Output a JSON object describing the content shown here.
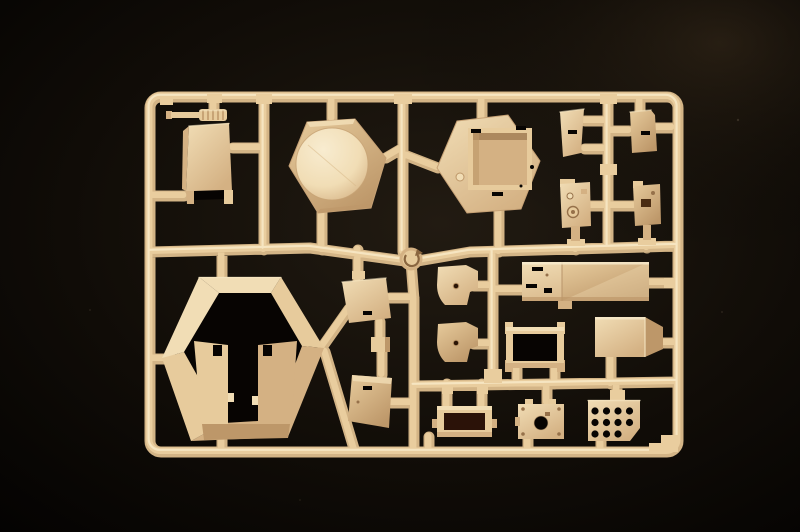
{
  "scene": {
    "type": "photograph",
    "subject": "injection-molded plastic model kit sprue (parts runner) for an armored-vehicle kit",
    "background": "black surface, soft vignette lighting",
    "material": "matte tan styrene plastic"
  },
  "colors": {
    "background": "#070503",
    "vignette_inner": "#221b12",
    "vignette_outer": "#020101",
    "vignette_glow": "#4e3c26",
    "runner_base": "#d3b486",
    "runner_mid": "#e9cd9e",
    "runner_highlight": "#f8e9c7",
    "plastic_highlight": "#f8ecd0",
    "plastic_light": "#f1ddb5",
    "plastic_mid": "#e7cb9c",
    "plastic_shade": "#d4b183",
    "plastic_shadow": "#bd9769",
    "plastic_dark": "#96714a",
    "hole": "#070402",
    "hole_warm": "#2b1208"
  },
  "sprue": {
    "frame": "rounded-rectangle outer runner frame with internal runner lattice",
    "gate_medallion": "circular injection-gate medallion with curved arrow mark at the central runner junction",
    "corner_tab": "L-shaped reinforcement tab inside the bottom-right frame corner",
    "part_count": 20,
    "grille": {
      "hole_count": 11,
      "hole_rows": [
        4,
        4,
        3
      ]
    },
    "parts": [
      {
        "name": "ribbed-cylinder",
        "description": "small ribbed cylindrical part with thin rod",
        "area": "top-left, above stowage box"
      },
      {
        "name": "stowage-box",
        "description": "rectangular box with chamfered edge and open underside",
        "area": "top-left"
      },
      {
        "name": "turret-roof",
        "description": "hexagonal panel with large raised circular disc",
        "area": "top-center"
      },
      {
        "name": "turret-base",
        "description": "hexagonal panel with recessed rectangular bay, corner slots and locating knob",
        "area": "top-center-right"
      },
      {
        "name": "wedge-panel-a",
        "description": "angled trapezoid panel with slot",
        "area": "top-right"
      },
      {
        "name": "wedge-panel-b",
        "description": "angled trapezoid panel with slot",
        "area": "top-right"
      },
      {
        "name": "sight-housing-a",
        "description": "small housing with round sight ring and mounting peg",
        "area": "upper-right"
      },
      {
        "name": "sight-housing-b",
        "description": "small housing with rectangular port and mounting peg",
        "area": "upper-right"
      },
      {
        "name": "turret-shell",
        "description": "large open hexagonal turret ring with notched inner front walls",
        "area": "bottom-left"
      },
      {
        "name": "skirt-wedge-a",
        "description": "trapezoid skirt panel with slot",
        "area": "center"
      },
      {
        "name": "spacer-block",
        "description": "small rectangular block",
        "area": "center"
      },
      {
        "name": "skirt-wedge-b",
        "description": "trapezoid skirt panel with slot",
        "area": "center"
      },
      {
        "name": "bracket-a",
        "description": "curved mounting bracket with small hole",
        "area": "center"
      },
      {
        "name": "bracket-b",
        "description": "curved mounting bracket with small hole",
        "area": "center"
      },
      {
        "name": "roof-plate",
        "description": "long two-section plate with small slots",
        "area": "center-right"
      },
      {
        "name": "folded-plate",
        "description": "rectangular plate with angled folded edge",
        "area": "center-right"
      },
      {
        "name": "open-frame-bin",
        "description": "rectangular open frame with corner posts",
        "area": "lower-center-right"
      },
      {
        "name": "hatch-frame",
        "description": "small rectangular frame with open center",
        "area": "bottom-center"
      },
      {
        "name": "access-plate",
        "description": "square plate with central round hole and corner fasteners",
        "area": "bottom-center"
      },
      {
        "name": "engine-grille",
        "description": "plate with 11 round holes in rows of 4/4/3 and a clipped corner",
        "area": "bottom-right"
      }
    ]
  }
}
